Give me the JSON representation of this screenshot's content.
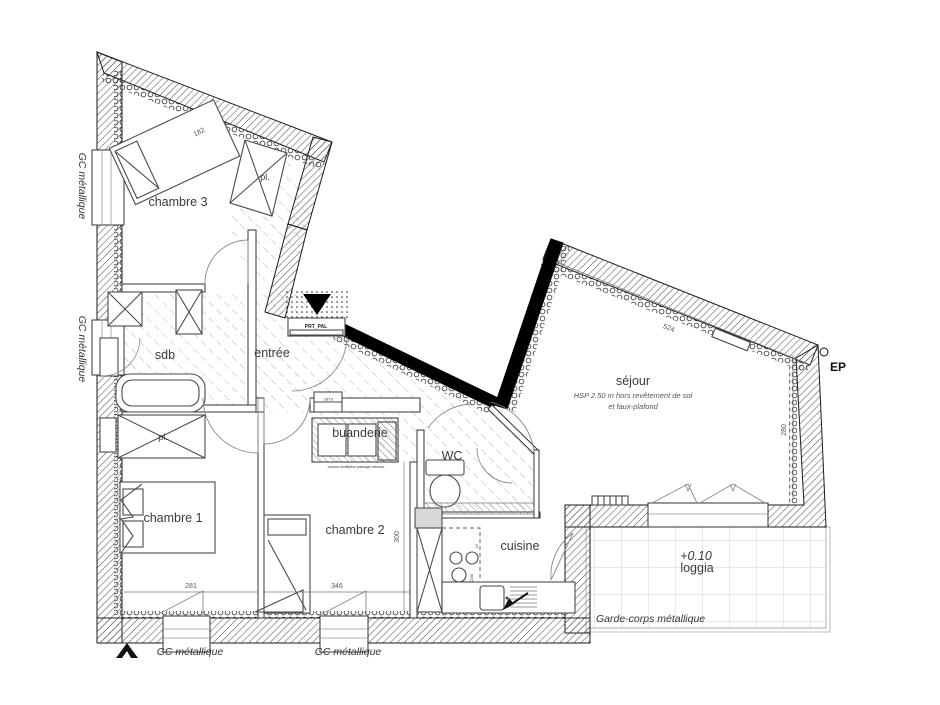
{
  "title": "plan d'appartement T4",
  "rooms": {
    "chambre3": "chambre 3",
    "sdb": "sdb",
    "entree": "entrée",
    "chambre1": "chambre 1",
    "chambre2": "chambre 2",
    "buanderie": "buanderie",
    "wc": "WC",
    "cuisine": "cuisine",
    "sejour": {
      "name": "séjour",
      "note_line1": "HSP 2.50 m hors revêtement de sol",
      "note_line2": "et faux-plafond"
    },
    "loggia": {
      "level": "+0.10",
      "name": "loggia"
    },
    "placard_chambre1": "pl.",
    "placard_chambre3": "pl."
  },
  "annotations": {
    "gc_metallique": "GC métallique",
    "garde_corps": "Garde-corps métallique",
    "ep": "EP",
    "porte_paliere": "PRT_PAL",
    "elec": "ELEC",
    "lave_vaisselle": "LV",
    "cuisson": "CUIS",
    "cloison_note": "cloison ventilation passage réseaux"
  },
  "dimensions": {
    "chambre1_width": "281",
    "chambre2_width": "346",
    "chambre2_height": "300",
    "sejour_height": "280",
    "sejour_width": "524",
    "lit_chambre3": "182"
  },
  "colors": {
    "wall": "#1a1a1a",
    "hatch": "#555555",
    "floor_hatch": "#aaaaaa",
    "text": "#3a3a3a"
  }
}
